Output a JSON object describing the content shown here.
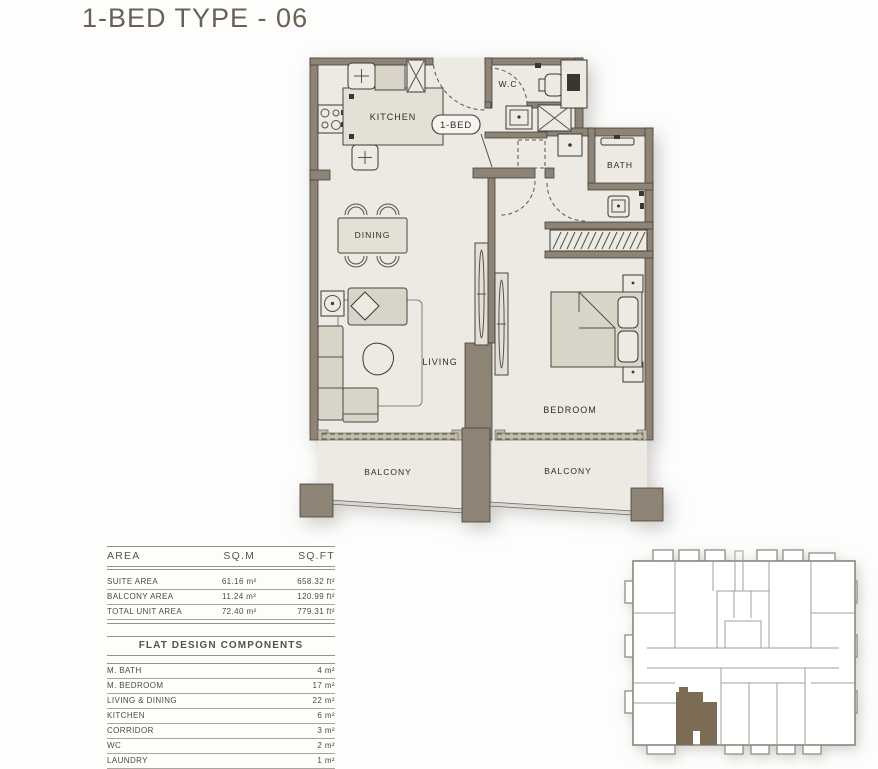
{
  "title": "1-BED TYPE - 06",
  "plan": {
    "labels": {
      "kitchen": "KITCHEN",
      "unit": "1-BED",
      "wc": "W.C",
      "bath": "BATH",
      "dining": "DINING",
      "living": "LIVING",
      "bedroom": "BEDROOM",
      "balcony_left": "BALCONY",
      "balcony_right": "BALCONY"
    }
  },
  "area_table": {
    "headers": [
      "AREA",
      "SQ.M",
      "SQ.FT"
    ],
    "rows": [
      {
        "label": "SUITE AREA",
        "sqm": "61.16 m²",
        "sqft": "658.32 ft²"
      },
      {
        "label": "BALCONY AREA",
        "sqm": "11.24 m²",
        "sqft": "120.99 ft²"
      },
      {
        "label": "TOTAL UNIT AREA",
        "sqm": "72.40 m²",
        "sqft": "779.31 ft²"
      }
    ]
  },
  "components_table": {
    "title": "FLAT DESIGN COMPONENTS",
    "rows": [
      {
        "label": "M. BATH",
        "value": "4 m²"
      },
      {
        "label": "M. BEDROOM",
        "value": "17 m²"
      },
      {
        "label": "LIVING & DINING",
        "value": "22 m²"
      },
      {
        "label": "KITCHEN",
        "value": "6 m²"
      },
      {
        "label": "CORRIDOR",
        "value": "3 m²"
      },
      {
        "label": "WC",
        "value": "2 m²"
      },
      {
        "label": "LAUNDRY",
        "value": "1 m²"
      }
    ]
  },
  "key_plan": {
    "highlighted_unit": "1-BED TYPE - 06",
    "highlight_color": "#7d6c55"
  },
  "colors": {
    "wall": "#8d8476",
    "floor": "#edeae3",
    "accent": "#7d6c55",
    "title": "#6b6054"
  }
}
